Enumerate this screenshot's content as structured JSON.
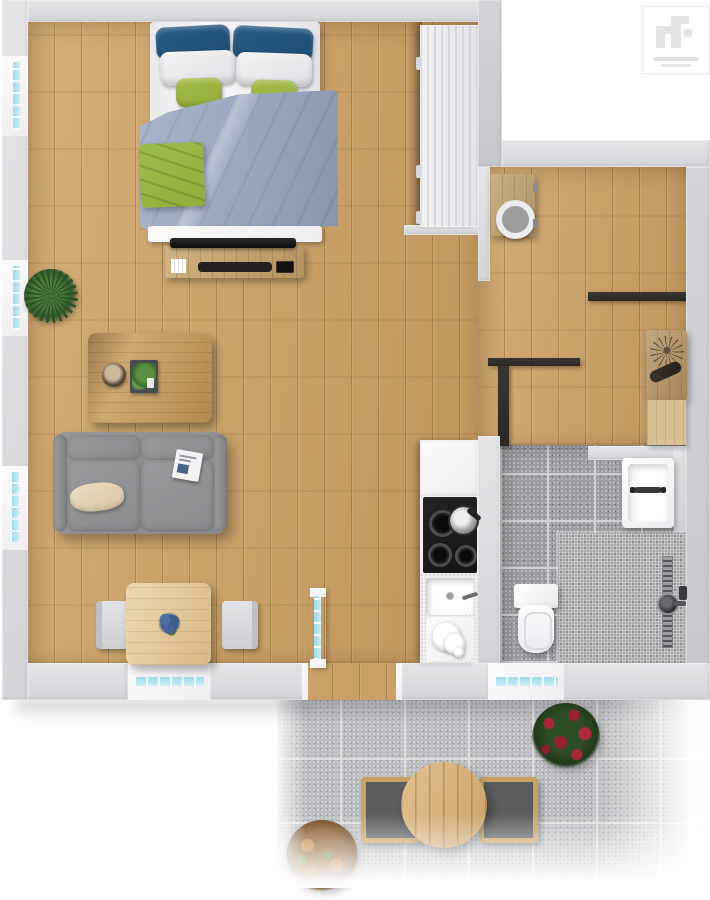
{
  "scene": {
    "type": "3d-floor-plan-top-view",
    "description": "Top-down 3D rendering of a one-bedroom apartment with open living/bedroom space, kitchen strip, hallway, bathroom and a tiled patio with outdoor furniture"
  },
  "palette": {
    "wall": "#d4d5d8",
    "wall-light": "#e4e5e7",
    "wall-dark": "#c6c7ca",
    "wood": "#c9a168",
    "console-wood": "#c2a06c",
    "table-wood": "#e2c493",
    "white-furn": "#eeeef1",
    "pillow-blue": "#1d4c72",
    "pillow-green": "#93ad3a",
    "duvet": "#9aa5be",
    "sofa": "#8a8a8d",
    "cushion-beige": "#dbc8a7",
    "cooktop": "#161616",
    "tile": "#9c9da0",
    "shower": "#a9aaac",
    "grout": "#cfd0d2",
    "patio": "#bcbdc0",
    "patio-grout": "#dededf",
    "glass": "#9fdbe9",
    "glass-light": "#cdeef6",
    "dark-wall": "#2c2925",
    "plant-green": "#3e6b34",
    "flower-red": "#a32836",
    "shrub-orange": "#b5722f",
    "marble": "#eceae6",
    "logo-gray": "#e3e4e6"
  },
  "logo": {
    "mark": "rf-monogram",
    "style": "white card with light gray geometric monogram and two faint tagline lines",
    "tagline_lines": 2
  },
  "rooms": {
    "bedroom": {
      "label": "Bedroom area"
    },
    "living": {
      "label": "Living area"
    },
    "dining": {
      "label": "Dining area"
    },
    "kitchen": {
      "label": "Kitchen strip"
    },
    "hallway": {
      "label": "Hallway"
    },
    "utility": {
      "label": "Utility room"
    },
    "study": {
      "label": "Hall with console desk"
    },
    "bathroom": {
      "label": "Bathroom"
    },
    "patio": {
      "label": "Patio terrace"
    }
  },
  "furniture": {
    "bed": {
      "label": "Double bed with blue, white and green pillows, gray-blue duvet and green throw"
    },
    "tv_console": {
      "label": "TV console with flat TV, soundbar, books and media device"
    },
    "floor_plant": {
      "label": "Green floor plant by the window"
    },
    "coffee_table": {
      "label": "Wooden coffee table with bowl and fern tray"
    },
    "sofa": {
      "label": "Gray two-seat sofa with beige pillow and magazine"
    },
    "dining_table": {
      "label": "Square dining table with blue flower centerpiece"
    },
    "dining_chair_left": {
      "label": "Dining chair (left)"
    },
    "dining_chair_right": {
      "label": "Dining chair (right)"
    },
    "tall_cabinets": {
      "label": "Tall kitchen cabinet run with handles"
    },
    "cooktop": {
      "label": "Black cooktop with two burners on and a pan"
    },
    "kitchen_sink": {
      "label": "Kitchen sink with faucet and stacked plates"
    },
    "washer_cabinet": {
      "label": "Wooden utility cabinet with round appliance door"
    },
    "console_desk": {
      "label": "Wooden console desk with dried-branch decor"
    },
    "bath_sink": {
      "label": "Bathroom washbasin with dark faucet"
    },
    "toilet": {
      "label": "Toilet with tank"
    },
    "shower": {
      "label": "Walk-in shower with linear drain and shower head"
    },
    "patio_table": {
      "label": "Round wooden patio table"
    },
    "patio_chair_left": {
      "label": "Patio chair (left)"
    },
    "patio_chair_right": {
      "label": "Patio chair (right)"
    },
    "patio_plant_red": {
      "label": "Red flowering patio plant"
    },
    "patio_shrub": {
      "label": "Orange patio shrub"
    }
  },
  "openings": {
    "window_left_1": {
      "label": "Window – bedroom, left wall"
    },
    "window_left_2": {
      "label": "Window – living, left wall"
    },
    "window_left_3": {
      "label": "Window – sofa corner, left wall"
    },
    "window_bottom": {
      "label": "Window – dining, bottom wall"
    },
    "window_bathroom": {
      "label": "Window – bathroom, bottom wall"
    },
    "patio_door": {
      "label": "Open glass patio door with wood threshold"
    }
  }
}
